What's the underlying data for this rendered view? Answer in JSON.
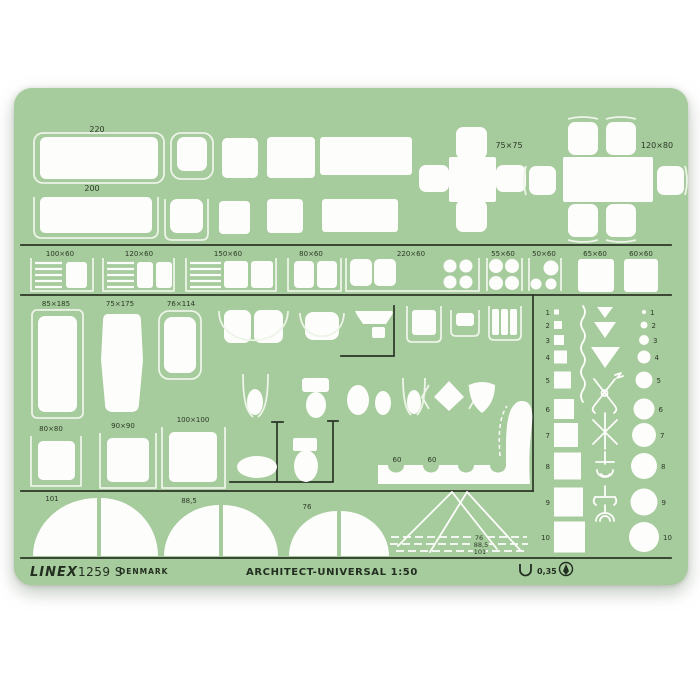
{
  "product": {
    "brand": "LINEX",
    "model": "1259 S",
    "country": "DENMARK",
    "title": "ARCHITECT-UNIVERSAL 1:50",
    "pen_width": "0,35"
  },
  "colors": {
    "template_green": "#a6cb9c",
    "cutout_white": "#fdfdfb",
    "engraved_line_dark": "#2a3626",
    "background": "#ffffff"
  },
  "dims": {
    "bed1": "220",
    "bed2": "200",
    "table1": "75×75",
    "table2": "120×80",
    "row3": [
      "100×60",
      "120×60",
      "150×60",
      "80×60",
      "220×60",
      "55×60",
      "50×60",
      "65×60",
      "60×60"
    ],
    "tub1": "85×185",
    "tub2": "75×175",
    "shower_tray": "76×114",
    "sq80": "80×80",
    "sq90": "90×90",
    "sq100": "100×100",
    "seat1": "60",
    "seat2": "60",
    "arc1": "101",
    "arc2": "88,5",
    "arc3": "76",
    "stair1": "76",
    "stair2": "88,5",
    "stair3": "101"
  },
  "scale_column": {
    "numbers": [
      "1",
      "2",
      "3",
      "4",
      "5",
      "6",
      "7",
      "8",
      "9",
      "10"
    ]
  }
}
